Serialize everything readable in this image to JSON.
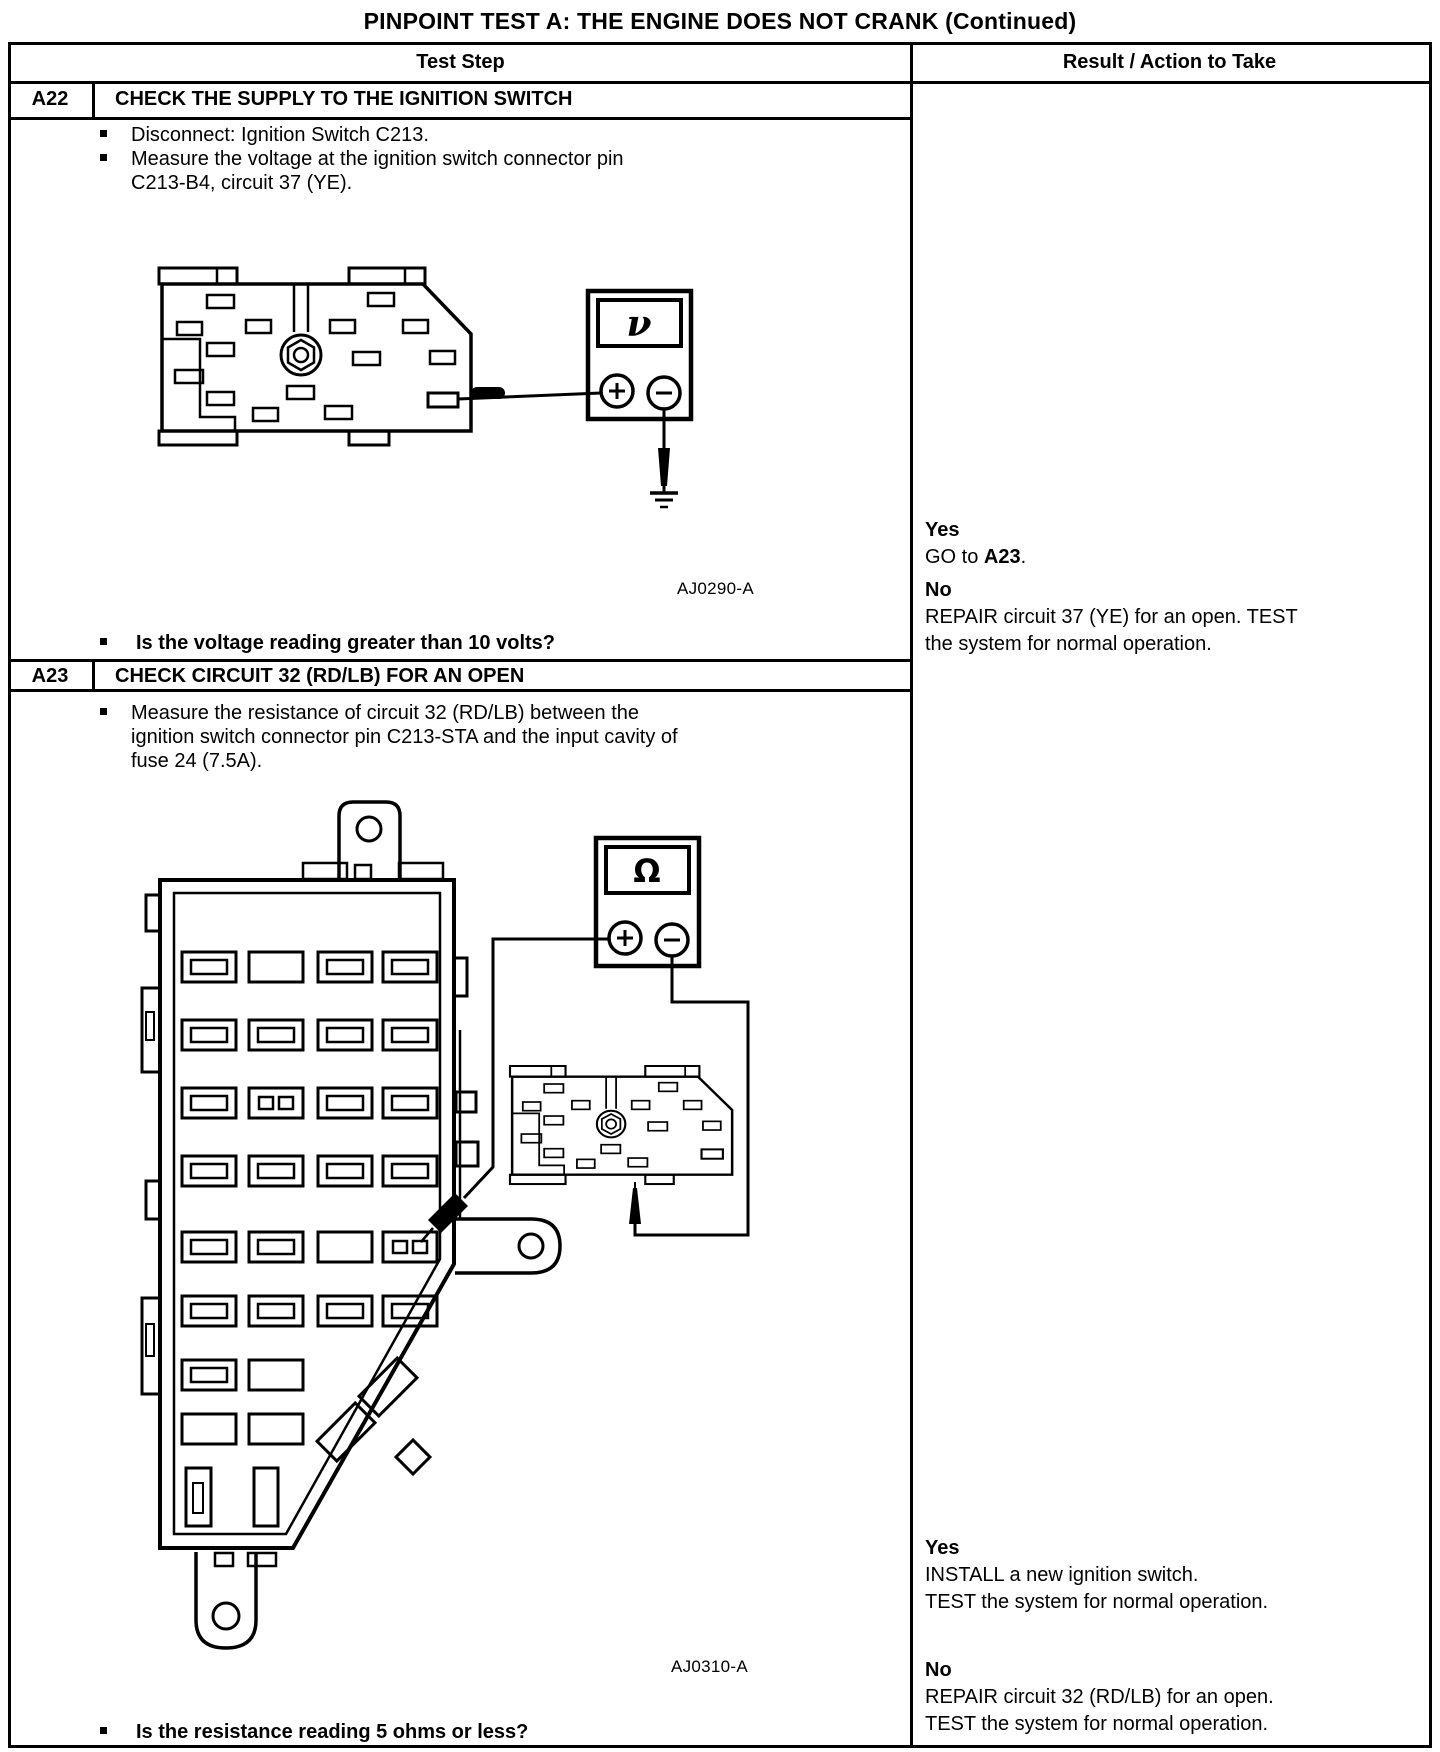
{
  "title": "PINPOINT TEST A: THE ENGINE DOES NOT CRANK (Continued)",
  "header": {
    "test_step": "Test Step",
    "result": "Result / Action to Take"
  },
  "a22": {
    "id": "A22",
    "title": "CHECK THE SUPPLY TO THE IGNITION SWITCH",
    "step_lines": [
      "Disconnect: Ignition Switch C213.",
      "Measure the voltage at the ignition switch connector pin",
      "C213-B4, circuit 37 (YE)."
    ],
    "diagram": {
      "meter_symbol": "ν",
      "figure_label": "AJ0290-A"
    },
    "question": "Is the voltage reading greater than 10 volts?",
    "result": {
      "yes_label": "Yes",
      "yes_before": "GO to ",
      "yes_bold": "A23",
      "yes_after": ".",
      "no_label": "No",
      "no_line1": "REPAIR circuit 37 (YE) for an open. TEST",
      "no_line2": "the system for normal operation."
    }
  },
  "a23": {
    "id": "A23",
    "title": "CHECK CIRCUIT 32 (RD/LB) FOR AN OPEN",
    "step_lines": [
      "Measure the resistance of circuit 32 (RD/LB) between the",
      "ignition switch connector pin C213-STA and the input cavity of",
      "fuse 24 (7.5A)."
    ],
    "diagram": {
      "meter_symbol": "Ω",
      "figure_label": "AJ0310-A"
    },
    "question": "Is the resistance reading 5 ohms or less?",
    "result": {
      "yes_label": "Yes",
      "yes_line1": "INSTALL a new ignition switch.",
      "yes_line2": "TEST the system for normal operation.",
      "no_label": "No",
      "no_line1": "REPAIR circuit 32 (RD/LB) for an open.",
      "no_line2": "TEST the system for normal operation."
    }
  }
}
